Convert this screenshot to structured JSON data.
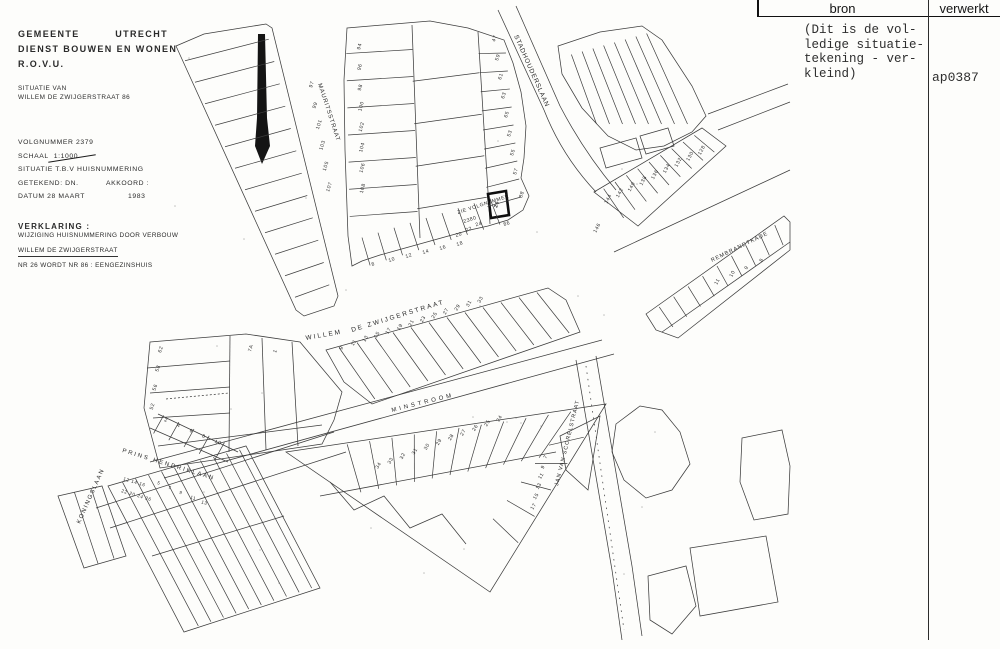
{
  "document": {
    "agency_line1_left": "GEMEENTE",
    "agency_line1_right": "UTRECHT",
    "agency_line2": "DIENST BOUWEN EN WONEN",
    "agency_line3": "R.O.V.U.",
    "situatie_label": "SITUATIE VAN",
    "situatie_value": "WILLEM DE ZWIJGERSTRAAT 86",
    "volgnummer": "VOLGNUMMER 2379",
    "schaal_label": "SCHAAL",
    "schaal_value": "1:1000",
    "situatie_tbv": "SITUATIE T.B.V HUISNUMMERING",
    "getekend": "GETEKEND: DN.",
    "akkoord": "AKKOORD :",
    "datum": "DATUM 28 MAART",
    "jaar": "1983",
    "verklaring_title": "VERKLARING :",
    "verklaring_line1": "WIJZIGING HUISNUMMERING DOOR VERBOUW",
    "verklaring_line2": "WILLEM DE ZWIJGERSTRAAT",
    "verklaring_line3": "NR 26 WORDT NR 86 : EENGEZINSHUIS"
  },
  "log_table": {
    "col_bron": "bron",
    "col_verwerkt": "verwerkt",
    "bron_note_lines": [
      "(Dit is de vol-",
      "ledige situatie-",
      "tekening - ver-",
      "kleind)"
    ],
    "verwerkt_value": "ap0387"
  },
  "map": {
    "street_labels": {
      "mauritsstraat": "MAURITSSTRAAT",
      "stadhouderslaan": "STADHOUDERSLAAN",
      "willem": "WILLEM",
      "de_zwijgerstraat": "DE ZWIJGERSTRAAT",
      "minstroom": "MINSTROOM",
      "prins_hendriklaan": "PRINS HENDRIKLAAN",
      "koningslaan": "KONINGSLAAN",
      "jan_van_scorelstraat": "JAN VAN SCORELSTRAAT",
      "rembrandtkade": "REMBRANDTKADE"
    },
    "annotation": {
      "line1": "ZIE VOLGNUMMER",
      "line2": "2380"
    },
    "highlight_plot": {
      "old_number": "26",
      "new_number": "86",
      "neighbor_number": "88"
    },
    "plot_numbers": {
      "a_west": [
        "97",
        "99",
        "101",
        "103",
        "105",
        "107"
      ],
      "b_left": [
        "94",
        "96",
        "98",
        "100",
        "102",
        "104",
        "106",
        "108"
      ],
      "b_right": [
        "47",
        "59",
        "61",
        "63",
        "65",
        "53",
        "55",
        "57"
      ],
      "b_bottom": [
        "8",
        "10",
        "12",
        "14",
        "16",
        "18"
      ],
      "b_bottom2": [
        "20",
        "22",
        "24"
      ],
      "h_row": [
        "9",
        "11",
        "13",
        "15",
        "17",
        "19",
        "21",
        "23",
        "25",
        "27",
        "29",
        "31",
        "33"
      ],
      "e_pre": [
        "146"
      ],
      "e_row": [
        "144",
        "142",
        "140",
        "138",
        "136",
        "134",
        "132",
        "130",
        "128"
      ],
      "f_row": [
        "11",
        "10",
        "9",
        "8"
      ],
      "j_top": [
        "34",
        "33",
        "32",
        "31",
        "30",
        "29",
        "28",
        "27",
        "26",
        "25",
        "24"
      ],
      "j_right": [
        "7",
        "9",
        "11",
        "13",
        "15",
        "17"
      ],
      "m_left": [
        "62",
        "58",
        "56",
        "52"
      ],
      "m_bottom": [
        "2",
        "4",
        "6",
        "8",
        "10"
      ],
      "m_topright": [
        "7A",
        "1"
      ],
      "k_row1": [
        "12",
        "14",
        "16"
      ],
      "k_row2": [
        "22",
        "20",
        "24",
        "26"
      ],
      "k_row3": [
        "5",
        "7",
        "9",
        "11",
        "13"
      ]
    }
  }
}
